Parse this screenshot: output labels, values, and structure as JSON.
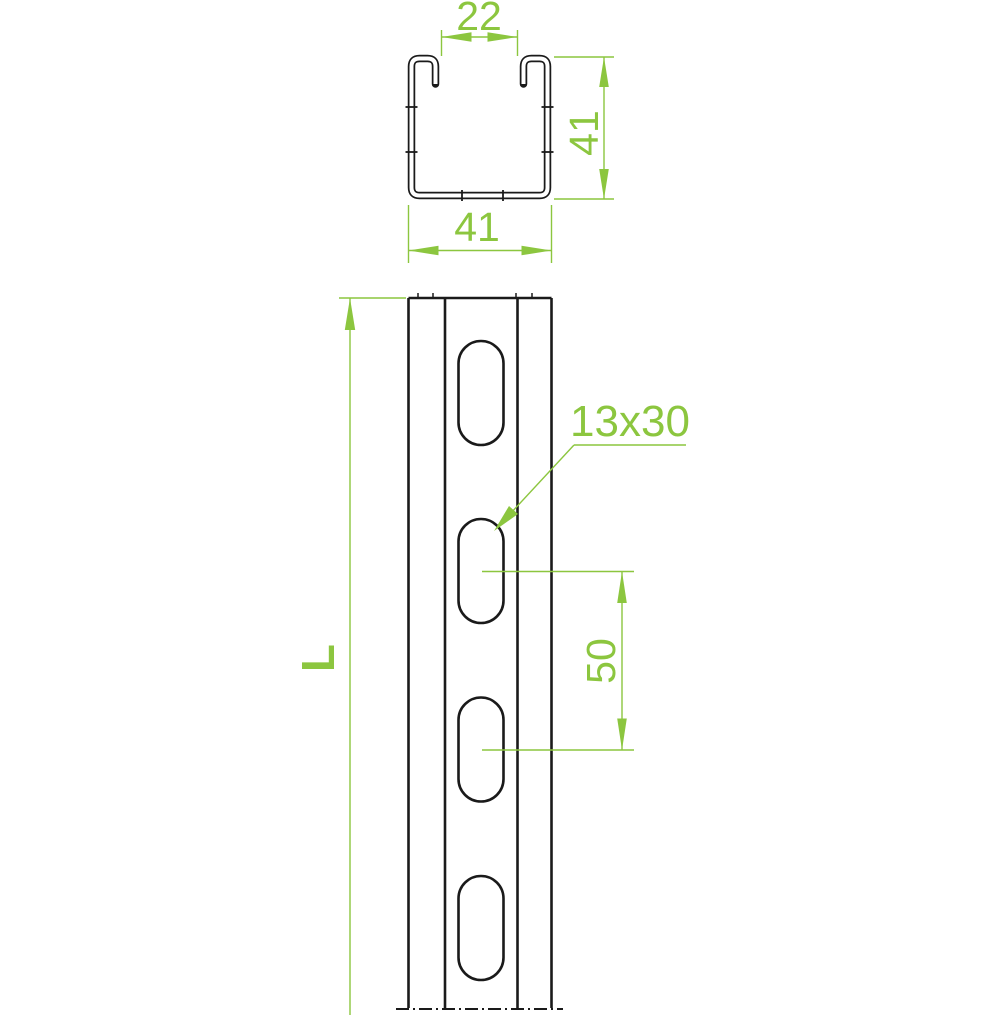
{
  "drawing": {
    "type": "technical-drawing",
    "subject": "slotted strut channel profile",
    "colors": {
      "dimension_accent": "#8CC63F",
      "outline": "#1A1A1A",
      "background": "#FFFFFF"
    },
    "cross_section_view": {
      "opening_width_label": "22",
      "height_label": "41",
      "width_label": "41"
    },
    "elevation_view": {
      "length_label": "L",
      "slot_size_label": "13x30",
      "slot_pitch_label": "50",
      "slot_count": 4
    }
  }
}
